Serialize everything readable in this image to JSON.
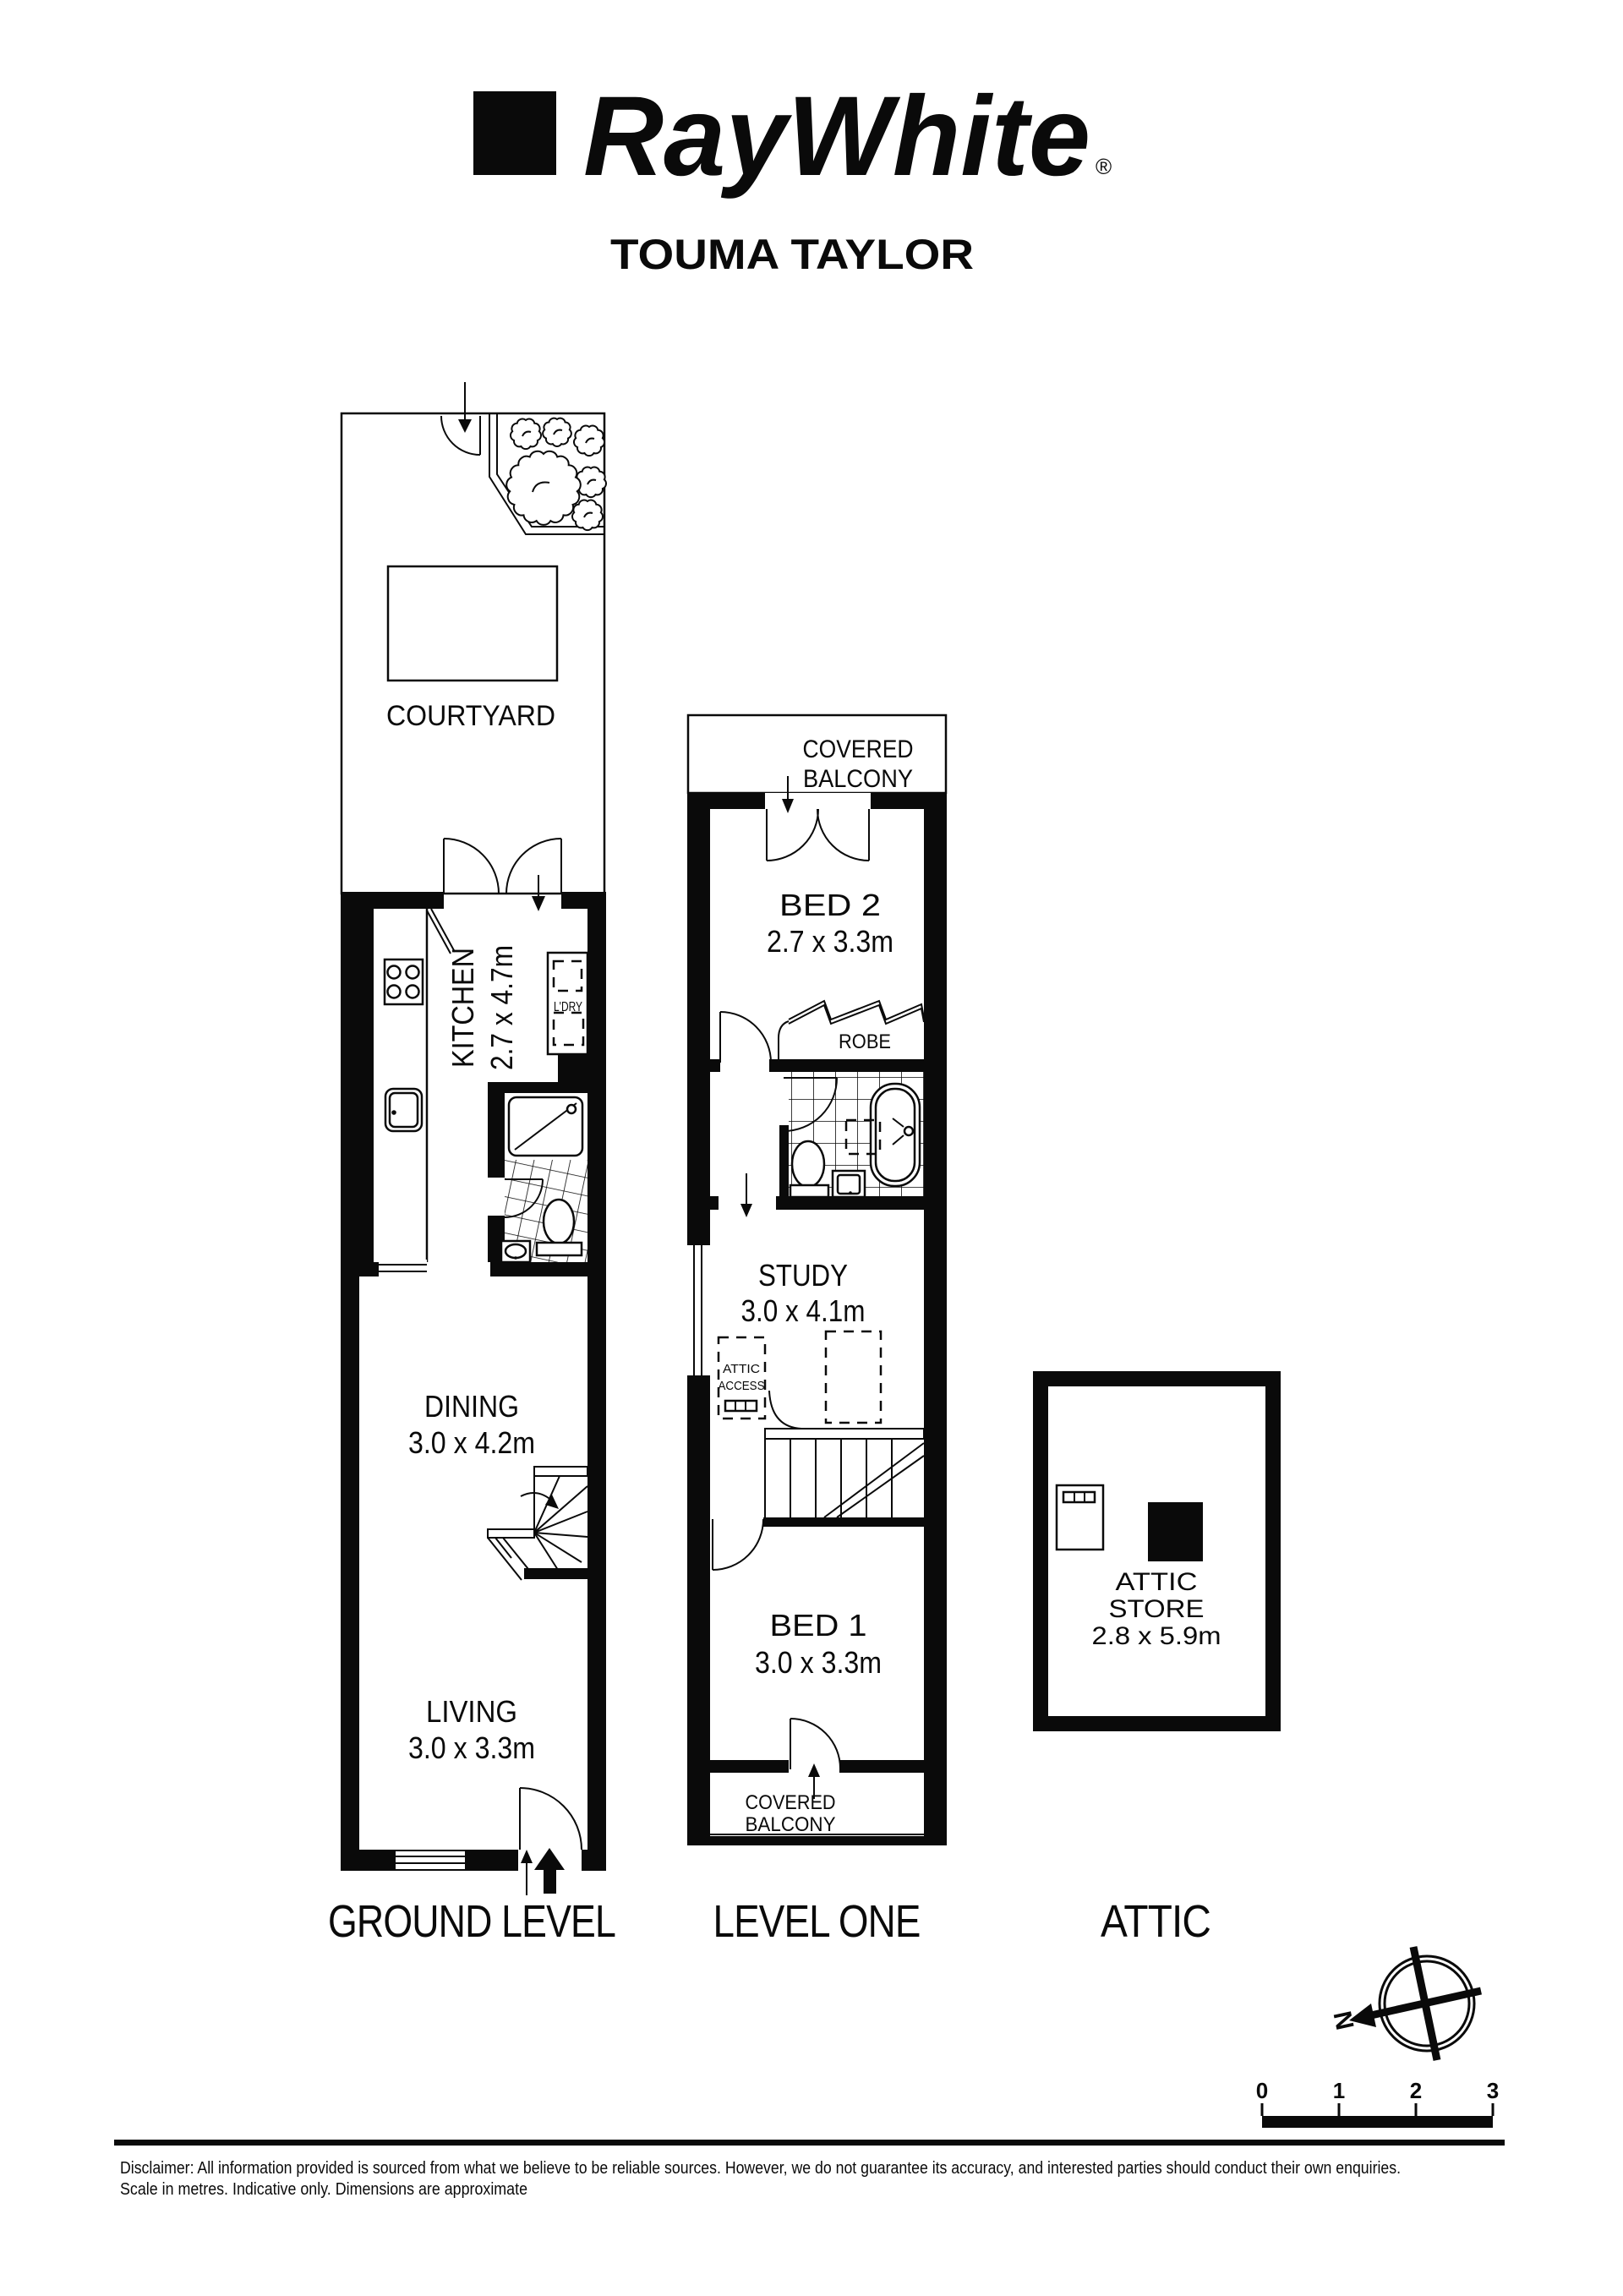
{
  "header": {
    "brand": "RayWhite",
    "trademark": "®",
    "agency": "TOUMA TAYLOR"
  },
  "rooms": {
    "courtyard": "COURTYARD",
    "kitchen": {
      "name": "KITCHEN",
      "dims": "2.7 x 4.7m"
    },
    "laundry": "L'DRY",
    "dining": {
      "name": "DINING",
      "dims": "3.0 x 4.2m"
    },
    "living": {
      "name": "LIVING",
      "dims": "3.0 x 3.3m"
    },
    "balcony_top": {
      "line1": "COVERED",
      "line2": "BALCONY"
    },
    "bed2": {
      "name": "BED 2",
      "dims": "2.7 x 3.3m"
    },
    "robe": "ROBE",
    "study": {
      "name": "STUDY",
      "dims": "3.0 x 4.1m"
    },
    "attic_access": {
      "line1": "ATTIC",
      "line2": "ACCESS"
    },
    "bed1": {
      "name": "BED 1",
      "dims": "3.0 x 3.3m"
    },
    "balcony_bottom": {
      "line1": "COVERED",
      "line2": "BALCONY"
    },
    "attic_store": {
      "line1": "ATTIC",
      "line2": "STORE",
      "dims": "2.8 x 5.9m"
    }
  },
  "levels": {
    "ground": "GROUND LEVEL",
    "one": "LEVEL ONE",
    "attic": "ATTIC"
  },
  "compass": {
    "north": "N"
  },
  "scale": {
    "ticks": [
      "0",
      "1",
      "2",
      "3"
    ]
  },
  "footer": {
    "line1": "Disclaimer: All information provided is sourced from what we believe to be reliable sources. However, we do not guarantee  its accuracy, and interested parties should conduct their own enquiries.",
    "line2": "Scale in metres. Indicative only. Dimensions are approximate"
  },
  "colors": {
    "ink": "#0a0a0a",
    "paper": "#ffffff"
  }
}
